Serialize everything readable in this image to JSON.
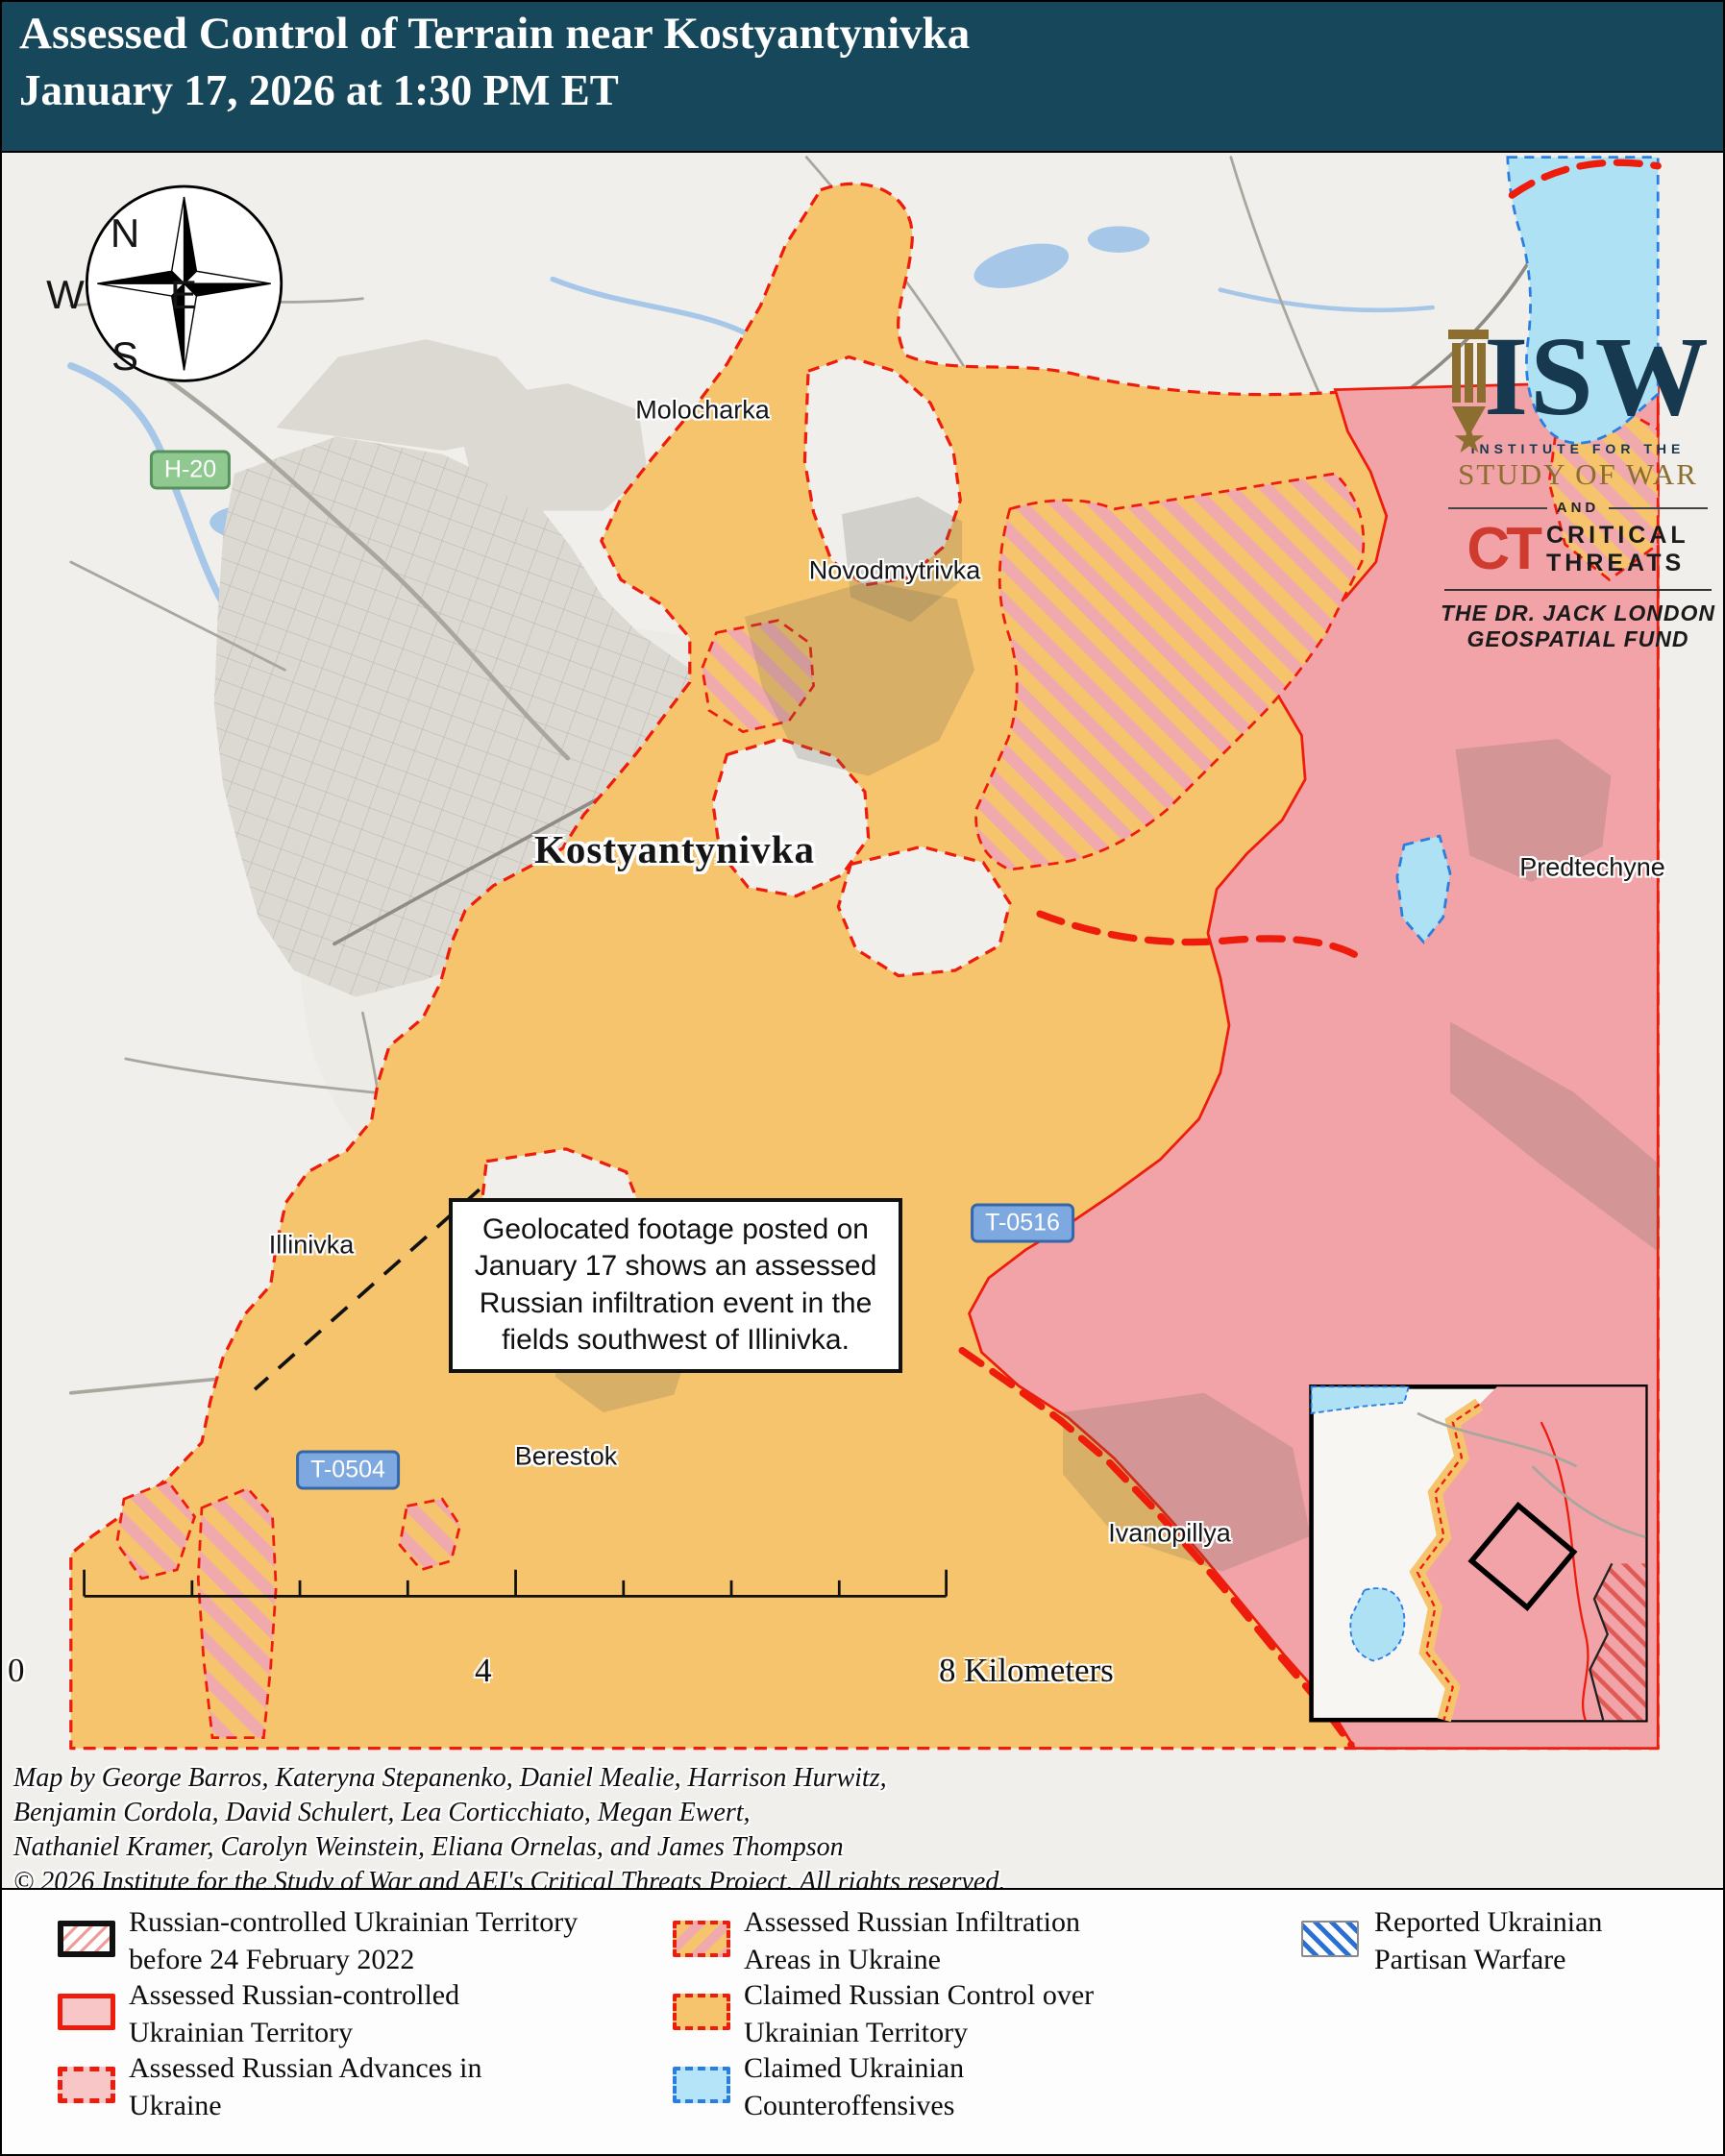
{
  "header": {
    "title_line1": "Assessed Control of Terrain near Kostyantynivka",
    "title_line2": "January 17, 2026 at 1:30 PM ET"
  },
  "logo": {
    "isw": "ISW",
    "institute": "INSTITUTE FOR THE",
    "study": "STUDY OF WAR",
    "and": "AND",
    "ct": "CT",
    "critical_line1": "CRITICAL",
    "critical_line2": "THREATS",
    "fund_line1": "THE DR. JACK LONDON",
    "fund_line2": "GEOSPATIAL FUND"
  },
  "compass": {
    "n": "N",
    "e": "E",
    "s": "S",
    "w": "W"
  },
  "map_labels": {
    "molocharka": "Molocharka",
    "novodmytrivka": "Novodmytrivka",
    "kostyantynivka": "Kostyantynivka",
    "predtechyne": "Predtechyne",
    "illinivka": "Illinivka",
    "berestok": "Berestok",
    "ivanopillya": "Ivanopillya"
  },
  "road_badges": {
    "h20": "H-20",
    "t0516": "T-0516",
    "t0504": "T-0504"
  },
  "annotation": {
    "text": "Geolocated footage posted on January 17 shows an assessed Russian infiltration event in the fields southwest of Illinivka."
  },
  "scalebar": {
    "zero": "0",
    "four": "4",
    "eight": "8 Kilometers"
  },
  "credits": {
    "line1": "Map by George Barros, Kateryna Stepanenko, Daniel Mealie, Harrison Hurwitz,",
    "line2": "Benjamin Cordola, David Schulert, Lea Corticchiato, Megan Ewert,",
    "line3": "Nathaniel Kramer, Carolyn Weinstein, Eliana Ornelas, and James Thompson",
    "line4": "© 2026 Institute for the Study of War and AEI's Critical Threats Project. All rights reserved."
  },
  "legend": {
    "items": [
      {
        "label": "Russian-controlled Ukrainian Territory before 24 February 2022"
      },
      {
        "label": "Assessed Russian-controlled Ukrainian Territory"
      },
      {
        "label": "Assessed Russian Advances in Ukraine"
      },
      {
        "label": "Assessed Russian Infiltration Areas in Ukraine"
      },
      {
        "label": "Claimed Russian Control over Ukrainian Territory"
      },
      {
        "label": "Claimed Ukrainian Counteroffensives"
      },
      {
        "label": "Reported Ukrainian Partisan Warfare"
      }
    ]
  },
  "colors": {
    "header_bg": "#16475a",
    "map_bg": "#f0efec",
    "urban": "#dcd9d2",
    "water": "#a7c7e8",
    "claimed_russian_orange": "#f6c46c",
    "assessed_russian_pink": "#f1a3a8",
    "infiltration_stripe_pink": "#f0a9ad",
    "ukrainian_counteroffensive_blue": "#aee1f4",
    "advance_red": "#ee1c0c",
    "ukrainian_dash_blue": "#2a7de1",
    "road_badge_green": "#8fc98f",
    "road_badge_blue": "#7da9e0"
  }
}
